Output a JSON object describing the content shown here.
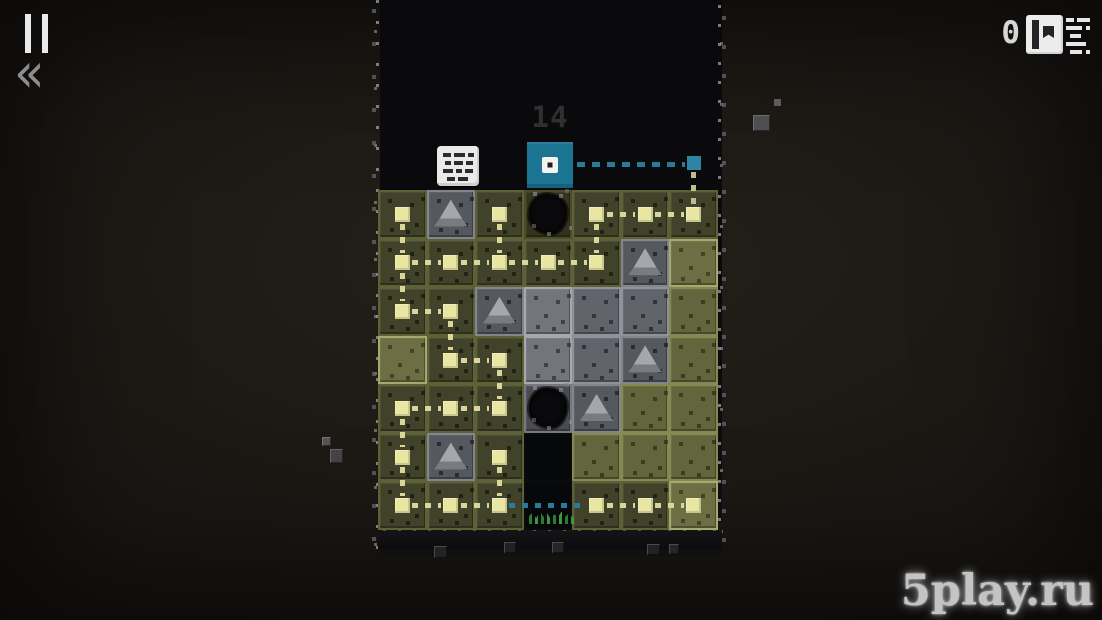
{
  "hud": {
    "pause_icon": "pause-icon",
    "rewind_glyph": "«",
    "flag_count": "0",
    "flag_icon": "flag-icon",
    "list_icon": "level-list-icon"
  },
  "board": {
    "rows": 7,
    "cols": 7,
    "player": {
      "label": "14",
      "grid_col": 4,
      "color": "#1b7492"
    },
    "checkpoint": {
      "row": 1,
      "col": 7,
      "color": "#2d84a3"
    },
    "tile_types": {
      "od": "dark-olive-path-tile",
      "o": "olive-tile",
      "ol": "light-olive-tile",
      "g": "stone-tile",
      "gl": "light-stone-tile",
      "gt": "stone-tile-pyramid",
      "hole-od": "pit-in-olive-tile",
      "hole-g": "pit-in-stone-tile",
      "void": "missing-tile",
      "void-sprout": "missing-tile-with-grass"
    },
    "tiles": [
      [
        "od",
        "gt",
        "od",
        "hole-od",
        "od",
        "od",
        "od"
      ],
      [
        "od",
        "od",
        "od",
        "od",
        "od",
        "gt",
        "ol"
      ],
      [
        "od",
        "od",
        "gt",
        "gl",
        "g",
        "g",
        "o"
      ],
      [
        "ol",
        "od",
        "od",
        "gl",
        "g",
        "gt",
        "o"
      ],
      [
        "od",
        "od",
        "od",
        "hole-g",
        "gt",
        "o",
        "o"
      ],
      [
        "od",
        "gt",
        "od",
        "void",
        "o",
        "o",
        "o"
      ],
      [
        "od",
        "od",
        "od",
        "void-sprout",
        "od",
        "od",
        "ol"
      ]
    ],
    "nodes": [
      [
        1,
        1
      ],
      [
        1,
        3
      ],
      [
        1,
        5
      ],
      [
        1,
        6
      ],
      [
        1,
        7
      ],
      [
        2,
        1
      ],
      [
        2,
        2
      ],
      [
        2,
        3
      ],
      [
        2,
        4
      ],
      [
        2,
        5
      ],
      [
        3,
        1
      ],
      [
        3,
        2
      ],
      [
        4,
        2
      ],
      [
        4,
        3
      ],
      [
        5,
        1
      ],
      [
        5,
        2
      ],
      [
        5,
        3
      ],
      [
        6,
        1
      ],
      [
        6,
        3
      ],
      [
        7,
        1
      ],
      [
        7,
        2
      ],
      [
        7,
        3
      ],
      [
        7,
        5
      ],
      [
        7,
        6
      ],
      [
        7,
        7
      ]
    ],
    "edges": [
      {
        "from": [
          1,
          1
        ],
        "to": [
          2,
          1
        ],
        "color": "yellow"
      },
      {
        "from": [
          1,
          3
        ],
        "to": [
          2,
          3
        ],
        "color": "yellow"
      },
      {
        "from": [
          1,
          5
        ],
        "to": [
          2,
          5
        ],
        "color": "yellow"
      },
      {
        "from": [
          1,
          5
        ],
        "to": [
          1,
          6
        ],
        "color": "yellow"
      },
      {
        "from": [
          1,
          6
        ],
        "to": [
          1,
          7
        ],
        "color": "yellow"
      },
      {
        "from": [
          2,
          1
        ],
        "to": [
          2,
          2
        ],
        "color": "yellow"
      },
      {
        "from": [
          2,
          2
        ],
        "to": [
          2,
          3
        ],
        "color": "yellow"
      },
      {
        "from": [
          2,
          3
        ],
        "to": [
          2,
          4
        ],
        "color": "yellow"
      },
      {
        "from": [
          2,
          4
        ],
        "to": [
          2,
          5
        ],
        "color": "yellow"
      },
      {
        "from": [
          2,
          1
        ],
        "to": [
          3,
          1
        ],
        "color": "yellow"
      },
      {
        "from": [
          3,
          1
        ],
        "to": [
          3,
          2
        ],
        "color": "yellow"
      },
      {
        "from": [
          3,
          2
        ],
        "to": [
          4,
          2
        ],
        "color": "yellow"
      },
      {
        "from": [
          4,
          2
        ],
        "to": [
          4,
          3
        ],
        "color": "yellow"
      },
      {
        "from": [
          4,
          3
        ],
        "to": [
          5,
          3
        ],
        "color": "yellow"
      },
      {
        "from": [
          5,
          1
        ],
        "to": [
          5,
          2
        ],
        "color": "yellow"
      },
      {
        "from": [
          5,
          2
        ],
        "to": [
          5,
          3
        ],
        "color": "yellow"
      },
      {
        "from": [
          5,
          1
        ],
        "to": [
          6,
          1
        ],
        "color": "yellow"
      },
      {
        "from": [
          6,
          1
        ],
        "to": [
          7,
          1
        ],
        "color": "yellow"
      },
      {
        "from": [
          6,
          3
        ],
        "to": [
          7,
          3
        ],
        "color": "yellow"
      },
      {
        "from": [
          7,
          1
        ],
        "to": [
          7,
          2
        ],
        "color": "yellow"
      },
      {
        "from": [
          7,
          2
        ],
        "to": [
          7,
          3
        ],
        "color": "yellow"
      },
      {
        "from": [
          7,
          3
        ],
        "to": [
          7,
          5
        ],
        "color": "teal"
      },
      {
        "from": [
          7,
          5
        ],
        "to": [
          7,
          6
        ],
        "color": "yellow"
      },
      {
        "from": [
          7,
          6
        ],
        "to": [
          7,
          7
        ],
        "color": "yellow"
      }
    ]
  },
  "debris": [
    {
      "x": 753,
      "y": 115,
      "w": 17,
      "h": 16,
      "c": "#4e4e50",
      "bevel": true
    },
    {
      "x": 774,
      "y": 99,
      "w": 7,
      "h": 7,
      "c": "#5c5c5e",
      "bevel": false
    },
    {
      "x": 322,
      "y": 437,
      "w": 9,
      "h": 9,
      "c": "#545456",
      "bevel": true
    },
    {
      "x": 330,
      "y": 449,
      "w": 13,
      "h": 14,
      "c": "#434345",
      "bevel": true
    },
    {
      "x": 434,
      "y": 546,
      "w": 13,
      "h": 12,
      "c": "#232325",
      "bevel": true
    },
    {
      "x": 504,
      "y": 542,
      "w": 12,
      "h": 11,
      "c": "#212123",
      "bevel": true
    },
    {
      "x": 552,
      "y": 542,
      "w": 12,
      "h": 11,
      "c": "#252527",
      "bevel": true
    },
    {
      "x": 647,
      "y": 544,
      "w": 13,
      "h": 11,
      "c": "#222224",
      "bevel": true
    },
    {
      "x": 669,
      "y": 544,
      "w": 10,
      "h": 10,
      "c": "#262628",
      "bevel": true
    }
  ],
  "watermark": {
    "text": "5play.ru"
  },
  "colors": {
    "page_bg": "#191613",
    "board_bg": "#0b0b0d",
    "player_teal": "#1b7492",
    "checkpoint_teal": "#2d84a3",
    "dash_yellow": "#d9d59b",
    "dash_teal": "#2a7b99",
    "node_fill": "#e9e6a4",
    "olive_dark": "#41422a",
    "olive": "#63653c",
    "olive_light": "#6d6e44",
    "stone": "#62646c",
    "stone_light": "#73757c",
    "stone_dark": "#565860",
    "move_label": "#303030",
    "hud_white": "#eaeaea"
  }
}
